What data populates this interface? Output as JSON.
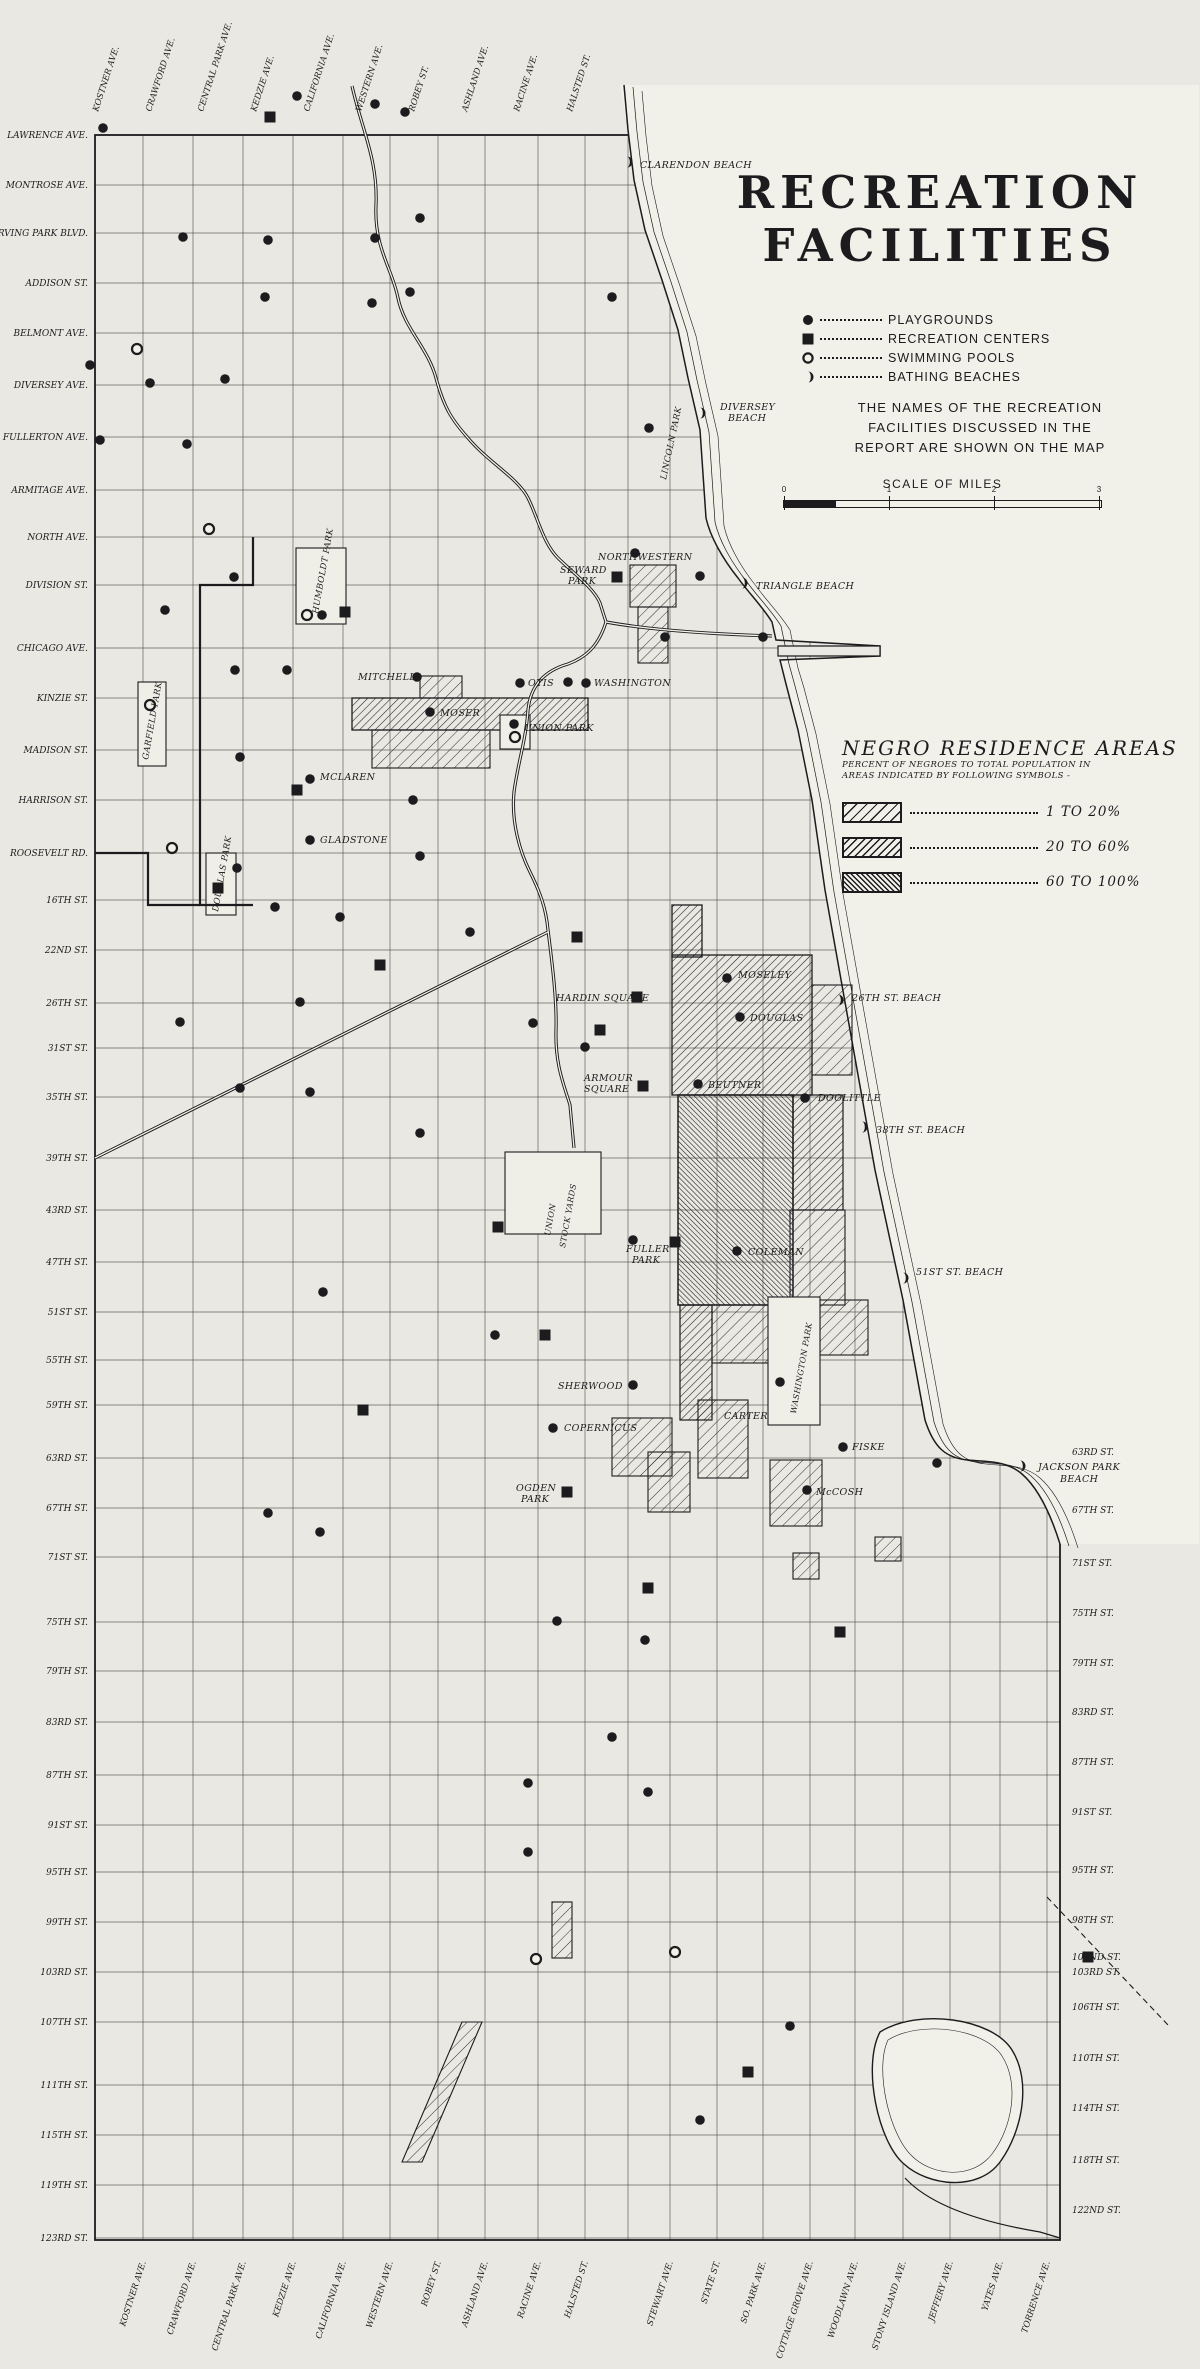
{
  "legend": {
    "title_line1": "RECREATION",
    "title_line2": "FACILITIES",
    "items": [
      {
        "symbol": "playground-dot",
        "label": "PLAYGROUNDS"
      },
      {
        "symbol": "recreation-center-square",
        "label": "RECREATION CENTERS"
      },
      {
        "symbol": "swimming-pool-circle",
        "label": "SWIMMING POOLS"
      },
      {
        "symbol": "bathing-beach-crescent",
        "label": "BATHING BEACHES"
      }
    ],
    "note_lines": [
      "THE NAMES OF THE RECREATION",
      "FACILITIES DISCUSSED IN THE",
      "REPORT ARE SHOWN ON THE MAP"
    ],
    "scale": {
      "title": "SCALE OF MILES",
      "ticks": [
        "0",
        "1",
        "2",
        "3"
      ]
    }
  },
  "negro_legend": {
    "title": "NEGRO RESIDENCE AREAS",
    "subtitle_lines": [
      "PERCENT OF NEGROES TO TOTAL POPULATION IN",
      "AREAS INDICATED BY FOLLOWING SYMBOLS -"
    ],
    "rows": [
      {
        "density": "light",
        "label": "1 TO 20%"
      },
      {
        "density": "medium",
        "label": "20 TO 60%"
      },
      {
        "density": "dense",
        "label": "60 TO 100%"
      }
    ]
  },
  "streets": {
    "left": [
      {
        "name": "LAWRENCE AVE.",
        "y": 135
      },
      {
        "name": "MONTROSE AVE.",
        "y": 185
      },
      {
        "name": "IRVING PARK BLVD.",
        "y": 233
      },
      {
        "name": "ADDISON ST.",
        "y": 283
      },
      {
        "name": "BELMONT AVE.",
        "y": 333
      },
      {
        "name": "DIVERSEY AVE.",
        "y": 385
      },
      {
        "name": "FULLERTON AVE.",
        "y": 437
      },
      {
        "name": "ARMITAGE AVE.",
        "y": 490
      },
      {
        "name": "NORTH AVE.",
        "y": 537
      },
      {
        "name": "DIVISION ST.",
        "y": 585
      },
      {
        "name": "CHICAGO AVE.",
        "y": 648
      },
      {
        "name": "KINZIE ST.",
        "y": 698
      },
      {
        "name": "MADISON ST.",
        "y": 750
      },
      {
        "name": "HARRISON ST.",
        "y": 800
      },
      {
        "name": "ROOSEVELT RD.",
        "y": 853
      },
      {
        "name": "16TH ST.",
        "y": 900
      },
      {
        "name": "22ND ST.",
        "y": 950
      },
      {
        "name": "26TH ST.",
        "y": 1003
      },
      {
        "name": "31ST ST.",
        "y": 1048
      },
      {
        "name": "35TH ST.",
        "y": 1097
      },
      {
        "name": "39TH ST.",
        "y": 1158
      },
      {
        "name": "43RD ST.",
        "y": 1210
      },
      {
        "name": "47TH ST.",
        "y": 1262
      },
      {
        "name": "51ST ST.",
        "y": 1312
      },
      {
        "name": "55TH ST.",
        "y": 1360
      },
      {
        "name": "59TH ST.",
        "y": 1405
      },
      {
        "name": "63RD ST.",
        "y": 1458
      },
      {
        "name": "67TH ST.",
        "y": 1508
      },
      {
        "name": "71ST ST.",
        "y": 1557
      },
      {
        "name": "75TH ST.",
        "y": 1622
      },
      {
        "name": "79TH ST.",
        "y": 1671
      },
      {
        "name": "83RD ST.",
        "y": 1722
      },
      {
        "name": "87TH ST.",
        "y": 1775
      },
      {
        "name": "91ST ST.",
        "y": 1825
      },
      {
        "name": "95TH ST.",
        "y": 1872
      },
      {
        "name": "99TH ST.",
        "y": 1922
      },
      {
        "name": "103RD ST.",
        "y": 1972
      },
      {
        "name": "107TH ST.",
        "y": 2022
      },
      {
        "name": "111TH ST.",
        "y": 2085
      },
      {
        "name": "115TH ST.",
        "y": 2135
      },
      {
        "name": "119TH ST.",
        "y": 2185
      },
      {
        "name": "123RD ST.",
        "y": 2238
      }
    ],
    "right": [
      {
        "name": "63RD ST.",
        "y": 1452
      },
      {
        "name": "67TH ST.",
        "y": 1510
      },
      {
        "name": "71ST ST.",
        "y": 1563
      },
      {
        "name": "75TH ST.",
        "y": 1613
      },
      {
        "name": "79TH ST.",
        "y": 1663
      },
      {
        "name": "83RD ST.",
        "y": 1712
      },
      {
        "name": "87TH ST.",
        "y": 1762
      },
      {
        "name": "91ST ST.",
        "y": 1812
      },
      {
        "name": "95TH ST.",
        "y": 1870
      },
      {
        "name": "98TH ST.",
        "y": 1920
      },
      {
        "name": "102ND ST.",
        "y": 1957
      },
      {
        "name": "103RD ST.",
        "y": 1972
      },
      {
        "name": "106TH ST.",
        "y": 2007
      },
      {
        "name": "110TH ST.",
        "y": 2058
      },
      {
        "name": "114TH ST.",
        "y": 2108
      },
      {
        "name": "118TH ST.",
        "y": 2160
      },
      {
        "name": "122ND ST.",
        "y": 2210
      }
    ],
    "top": [
      {
        "name": "KOSTNER AVE.",
        "x": 95
      },
      {
        "name": "CRAWFORD AVE.",
        "x": 148
      },
      {
        "name": "CENTRAL PARK AVE.",
        "x": 200
      },
      {
        "name": "KEDZIE AVE.",
        "x": 253
      },
      {
        "name": "CALIFORNIA AVE.",
        "x": 306
      },
      {
        "name": "WESTERN AVE.",
        "x": 358
      },
      {
        "name": "ROBEY ST.",
        "x": 411
      },
      {
        "name": "ASHLAND AVE.",
        "x": 464
      },
      {
        "name": "RACINE AVE.",
        "x": 516
      },
      {
        "name": "HALSTED ST.",
        "x": 569
      }
    ],
    "bottom": [
      {
        "name": "KOSTNER AVE.",
        "x": 143
      },
      {
        "name": "CRAWFORD AVE.",
        "x": 193
      },
      {
        "name": "CENTRAL PARK AVE.",
        "x": 243
      },
      {
        "name": "KEDZIE AVE.",
        "x": 293
      },
      {
        "name": "CALIFORNIA AVE.",
        "x": 343
      },
      {
        "name": "WESTERN AVE.",
        "x": 390
      },
      {
        "name": "ROBEY ST.",
        "x": 438
      },
      {
        "name": "ASHLAND AVE.",
        "x": 485
      },
      {
        "name": "RACINE AVE.",
        "x": 538
      },
      {
        "name": "HALSTED ST.",
        "x": 585
      },
      {
        "name": "STEWART AVE.",
        "x": 670
      },
      {
        "name": "STATE ST.",
        "x": 717
      },
      {
        "name": "SO. PARK AVE.",
        "x": 763
      },
      {
        "name": "COTTAGE GROVE AVE.",
        "x": 810
      },
      {
        "name": "WOODLAWN AVE.",
        "x": 855
      },
      {
        "name": "STONY ISLAND AVE.",
        "x": 903
      },
      {
        "name": "JEFFERY AVE.",
        "x": 950
      },
      {
        "name": "YATES AVE.",
        "x": 1000
      },
      {
        "name": "TORRENCE AVE.",
        "x": 1047
      }
    ]
  },
  "map_labels": [
    {
      "text": "CLARENDON BEACH",
      "x": 640,
      "y": 168
    },
    {
      "text": "DIVERSEY",
      "x": 720,
      "y": 410
    },
    {
      "text": "BEACH",
      "x": 728,
      "y": 421
    },
    {
      "text": "LINCOLN PARK",
      "x": 666,
      "y": 480,
      "rot": -78,
      "size": 8.5
    },
    {
      "text": "NORTHWESTERN",
      "x": 598,
      "y": 560
    },
    {
      "text": "SEWARD",
      "x": 560,
      "y": 573
    },
    {
      "text": "PARK",
      "x": 568,
      "y": 584
    },
    {
      "text": "TRIANGLE BEACH",
      "x": 756,
      "y": 589
    },
    {
      "text": "HUMBOLDT PARK",
      "x": 318,
      "y": 614,
      "rot": -80,
      "size": 8.5
    },
    {
      "text": "MITCHELL",
      "x": 358,
      "y": 680
    },
    {
      "text": "OTIS",
      "x": 528,
      "y": 686
    },
    {
      "text": "WASHINGTON",
      "x": 594,
      "y": 686
    },
    {
      "text": "MOSER",
      "x": 440,
      "y": 716
    },
    {
      "text": "UNION PARK",
      "x": 524,
      "y": 731
    },
    {
      "text": "GARFIELD PARK",
      "x": 148,
      "y": 760,
      "rot": -80,
      "size": 8.5
    },
    {
      "text": "MCLAREN",
      "x": 320,
      "y": 780
    },
    {
      "text": "GLADSTONE",
      "x": 320,
      "y": 843
    },
    {
      "text": "DOUGLAS PARK",
      "x": 218,
      "y": 912,
      "rot": -80,
      "size": 8.5
    },
    {
      "text": "HARDIN SQUARE",
      "x": 556,
      "y": 1001
    },
    {
      "text": "MOSELEY",
      "x": 738,
      "y": 978
    },
    {
      "text": "DOUGLAS",
      "x": 750,
      "y": 1021
    },
    {
      "text": "26TH ST. BEACH",
      "x": 852,
      "y": 1001
    },
    {
      "text": "ARMOUR",
      "x": 584,
      "y": 1081
    },
    {
      "text": "SQUARE",
      "x": 584,
      "y": 1092
    },
    {
      "text": "BEUTNER",
      "x": 708,
      "y": 1088
    },
    {
      "text": "DOOLITTLE",
      "x": 818,
      "y": 1101
    },
    {
      "text": "38TH ST. BEACH",
      "x": 876,
      "y": 1133
    },
    {
      "text": "UNION",
      "x": 550,
      "y": 1236,
      "rot": -80,
      "size": 8
    },
    {
      "text": "STOCK YARDS",
      "x": 565,
      "y": 1248,
      "rot": -80,
      "size": 8
    },
    {
      "text": "FULLER",
      "x": 626,
      "y": 1252
    },
    {
      "text": "PARK",
      "x": 632,
      "y": 1263
    },
    {
      "text": "COLEMAN",
      "x": 748,
      "y": 1255
    },
    {
      "text": "51ST ST. BEACH",
      "x": 916,
      "y": 1275
    },
    {
      "text": "WASHINGTON PARK",
      "x": 796,
      "y": 1414,
      "rot": -80,
      "size": 8
    },
    {
      "text": "SHERWOOD",
      "x": 558,
      "y": 1389
    },
    {
      "text": "COPERNICUS",
      "x": 564,
      "y": 1431
    },
    {
      "text": "OGDEN",
      "x": 516,
      "y": 1491
    },
    {
      "text": "PARK",
      "x": 521,
      "y": 1502
    },
    {
      "text": "CARTER",
      "x": 724,
      "y": 1419
    },
    {
      "text": "FISKE",
      "x": 852,
      "y": 1450
    },
    {
      "text": "McCOSH",
      "x": 816,
      "y": 1495
    },
    {
      "text": "JACKSON PARK",
      "x": 1038,
      "y": 1470
    },
    {
      "text": "BEACH",
      "x": 1060,
      "y": 1482
    }
  ],
  "markers": {
    "playgrounds": [
      [
        297,
        96
      ],
      [
        375,
        104
      ],
      [
        405,
        112
      ],
      [
        103,
        128
      ],
      [
        183,
        237
      ],
      [
        268,
        240
      ],
      [
        375,
        238
      ],
      [
        420,
        218
      ],
      [
        265,
        297
      ],
      [
        372,
        303
      ],
      [
        612,
        297
      ],
      [
        410,
        292
      ],
      [
        90,
        365
      ],
      [
        150,
        383
      ],
      [
        225,
        379
      ],
      [
        100,
        440
      ],
      [
        187,
        444
      ],
      [
        649,
        428
      ],
      [
        234,
        577
      ],
      [
        165,
        610
      ],
      [
        635,
        553
      ],
      [
        700,
        576
      ],
      [
        322,
        615
      ],
      [
        235,
        670
      ],
      [
        287,
        670
      ],
      [
        417,
        677
      ],
      [
        520,
        683
      ],
      [
        586,
        683
      ],
      [
        430,
        712
      ],
      [
        514,
        724
      ],
      [
        665,
        637
      ],
      [
        763,
        637
      ],
      [
        568,
        682
      ],
      [
        240,
        757
      ],
      [
        310,
        779
      ],
      [
        413,
        800
      ],
      [
        310,
        840
      ],
      [
        420,
        856
      ],
      [
        237,
        868
      ],
      [
        275,
        907
      ],
      [
        340,
        917
      ],
      [
        470,
        932
      ],
      [
        300,
        1002
      ],
      [
        585,
        1047
      ],
      [
        180,
        1022
      ],
      [
        240,
        1088
      ],
      [
        310,
        1092
      ],
      [
        420,
        1133
      ],
      [
        533,
        1023
      ],
      [
        727,
        978
      ],
      [
        740,
        1017
      ],
      [
        698,
        1084
      ],
      [
        805,
        1098
      ],
      [
        633,
        1240
      ],
      [
        737,
        1251
      ],
      [
        780,
        1382
      ],
      [
        633,
        1385
      ],
      [
        553,
        1428
      ],
      [
        495,
        1335
      ],
      [
        323,
        1292
      ],
      [
        843,
        1447
      ],
      [
        807,
        1490
      ],
      [
        937,
        1463
      ],
      [
        268,
        1513
      ],
      [
        320,
        1532
      ],
      [
        557,
        1621
      ],
      [
        645,
        1640
      ],
      [
        612,
        1737
      ],
      [
        528,
        1783
      ],
      [
        648,
        1792
      ],
      [
        528,
        1852
      ],
      [
        790,
        2026
      ],
      [
        700,
        2120
      ]
    ],
    "recreation_centers": [
      [
        270,
        117
      ],
      [
        617,
        577
      ],
      [
        345,
        612
      ],
      [
        297,
        790
      ],
      [
        218,
        888
      ],
      [
        380,
        965
      ],
      [
        577,
        937
      ],
      [
        637,
        997
      ],
      [
        600,
        1030
      ],
      [
        643,
        1086
      ],
      [
        675,
        1242
      ],
      [
        498,
        1227
      ],
      [
        545,
        1335
      ],
      [
        363,
        1410
      ],
      [
        567,
        1492
      ],
      [
        648,
        1588
      ],
      [
        840,
        1632
      ],
      [
        1088,
        1957
      ],
      [
        748,
        2072
      ]
    ],
    "swimming_pools": [
      [
        137,
        349
      ],
      [
        209,
        529
      ],
      [
        307,
        615
      ],
      [
        150,
        705
      ],
      [
        515,
        737
      ],
      [
        172,
        848
      ],
      [
        536,
        1959
      ],
      [
        675,
        1952
      ]
    ],
    "bathing_beaches": [
      [
        627,
        162
      ],
      [
        700,
        413
      ],
      [
        742,
        583
      ],
      [
        838,
        1000
      ],
      [
        862,
        1127
      ],
      [
        903,
        1278
      ],
      [
        1020,
        1466
      ]
    ]
  },
  "grid": {
    "left": 95,
    "right": 1060,
    "top": 135,
    "bottom": 2240,
    "cols": [
      95,
      143,
      193,
      243,
      293,
      343,
      390,
      438,
      485,
      538,
      585,
      628,
      670,
      717,
      763,
      810,
      855,
      903,
      950,
      1000,
      1047
    ],
    "rows": [
      135,
      185,
      233,
      283,
      333,
      385,
      437,
      490,
      537,
      585,
      648,
      698,
      750,
      800,
      853,
      900,
      950,
      1003,
      1048,
      1097,
      1158,
      1210,
      1262,
      1312,
      1360,
      1405,
      1458,
      1508,
      1557,
      1622,
      1671,
      1722,
      1775,
      1825,
      1872,
      1922,
      1972,
      2022,
      2085,
      2135,
      2185,
      2238
    ]
  },
  "colors": {
    "ink": "#1c1c1e",
    "paper": "#e9e8e2",
    "lake": "#f1f0e9"
  }
}
